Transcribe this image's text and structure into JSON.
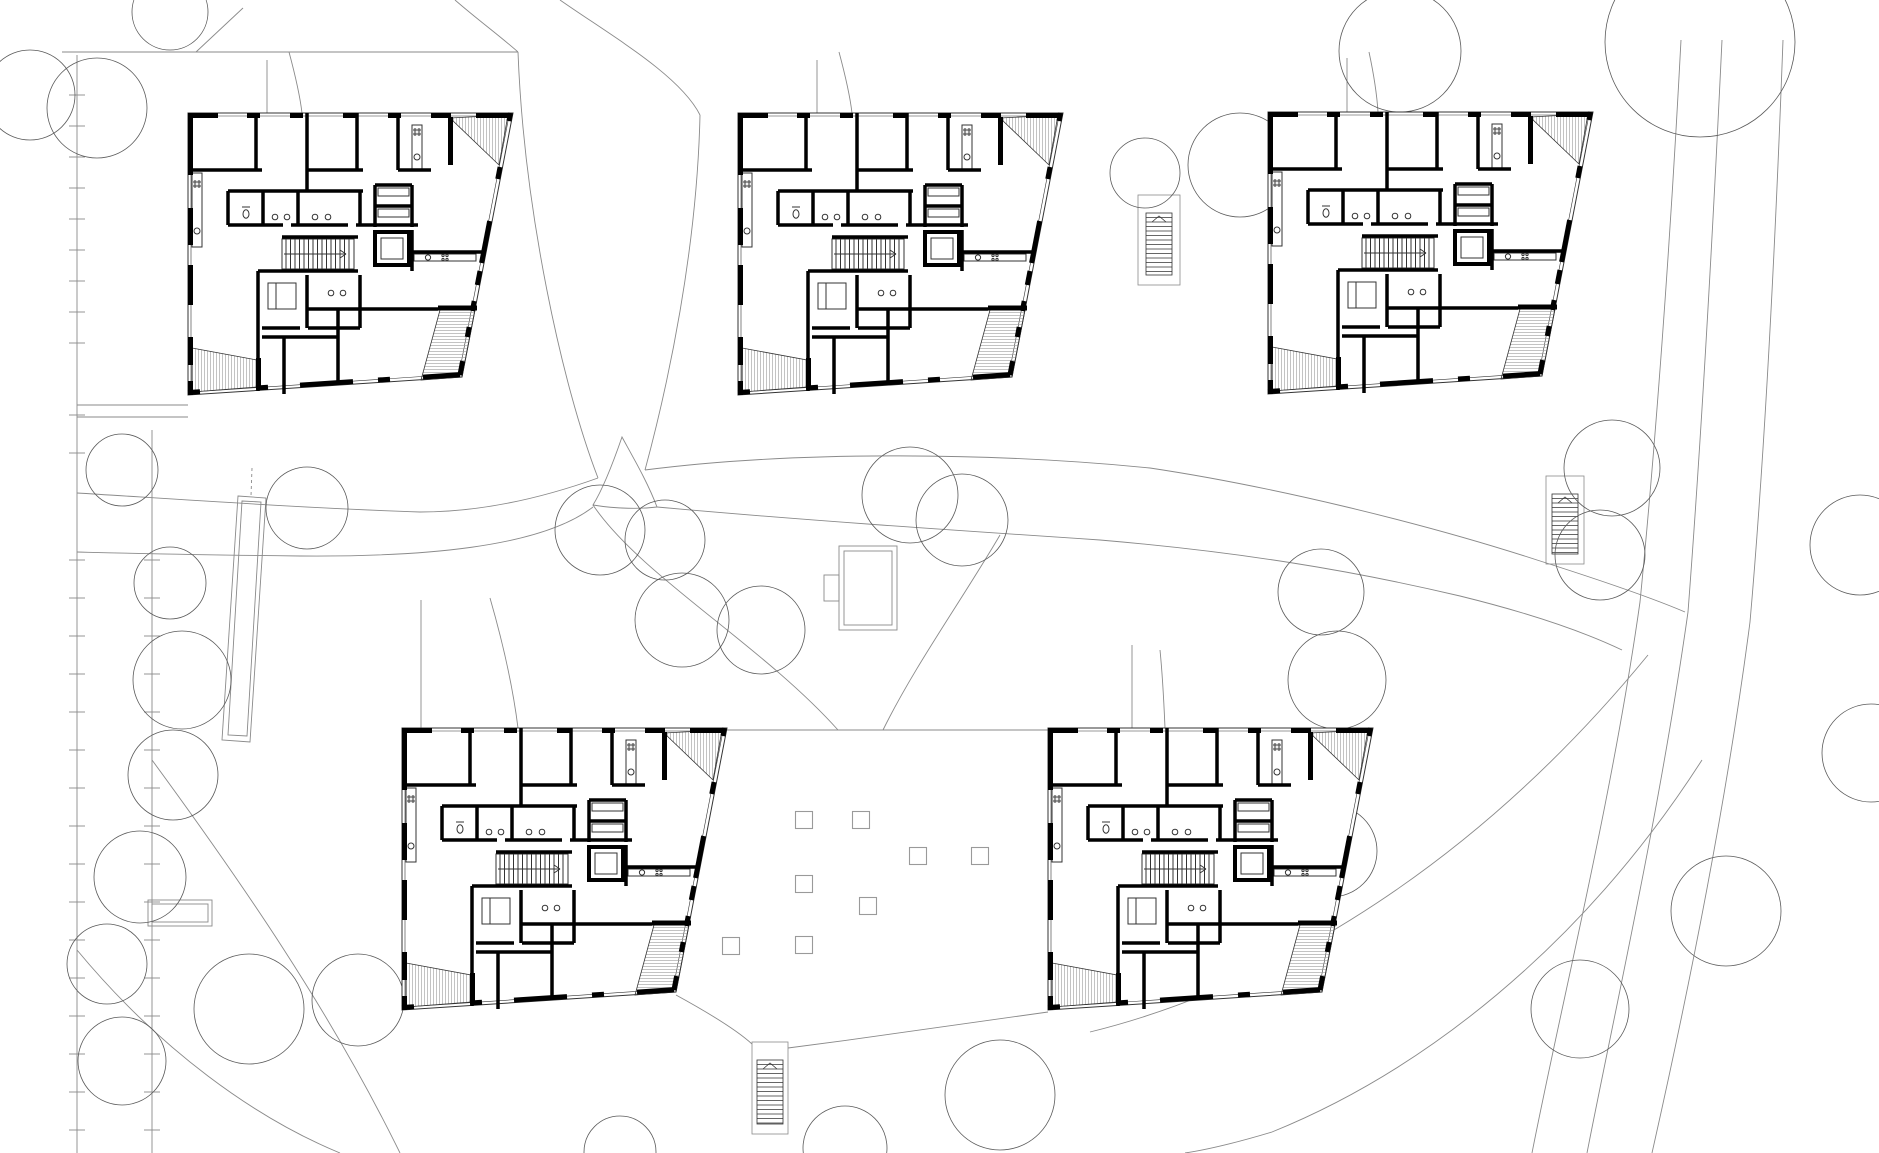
{
  "meta": {
    "drawing_type": "architectural-site-plan-ground-floor",
    "canvas_width": 1879,
    "canvas_height": 1153,
    "building_count": 5,
    "aria_label": "architectural site plan with five apartment building floor plans"
  },
  "style": {
    "background": "#ffffff",
    "wall_color": "#000000",
    "interior_line": "#333333",
    "site_line": "#8a8a8a",
    "tree_line": "#5a5a5a",
    "hatch_line": "#9a9a9a",
    "square_line": "#9a9a9a"
  },
  "buildings": [
    {
      "id": "building-1",
      "x": 188,
      "y": 113
    },
    {
      "id": "building-2",
      "x": 738,
      "y": 113
    },
    {
      "id": "building-3",
      "x": 1268,
      "y": 112
    },
    {
      "id": "building-4",
      "x": 402,
      "y": 728
    },
    {
      "id": "building-5",
      "x": 1048,
      "y": 728
    }
  ],
  "trees": [
    [
      97,
      108,
      50
    ],
    [
      30,
      95,
      45
    ],
    [
      170,
      12,
      38
    ],
    [
      122,
      470,
      36
    ],
    [
      307,
      508,
      41
    ],
    [
      170,
      583,
      36
    ],
    [
      182,
      680,
      49
    ],
    [
      173,
      775,
      45
    ],
    [
      140,
      877,
      46
    ],
    [
      107,
      964,
      40
    ],
    [
      122,
      1061,
      44
    ],
    [
      249,
      1009,
      55
    ],
    [
      358,
      1000,
      46
    ],
    [
      682,
      620,
      47
    ],
    [
      761,
      630,
      44
    ],
    [
      600,
      530,
      45
    ],
    [
      665,
      540,
      40
    ],
    [
      910,
      495,
      48
    ],
    [
      962,
      520,
      46
    ],
    [
      1145,
      173,
      35
    ],
    [
      1240,
      165,
      52
    ],
    [
      1400,
      51,
      61
    ],
    [
      1700,
      42,
      95
    ],
    [
      1612,
      468,
      48
    ],
    [
      1600,
      555,
      45
    ],
    [
      1321,
      592,
      43
    ],
    [
      1337,
      680,
      49
    ],
    [
      1318,
      772,
      40
    ],
    [
      1331,
      851,
      46
    ],
    [
      1245,
      942,
      55
    ],
    [
      1580,
      1009,
      49
    ],
    [
      1726,
      911,
      55
    ],
    [
      1860,
      545,
      50
    ],
    [
      1871,
      753,
      49
    ],
    [
      620,
      1152,
      36
    ],
    [
      845,
      1148,
      42
    ],
    [
      1000,
      1095,
      55
    ]
  ],
  "plaza": {
    "square_size": 17,
    "squares": [
      [
        804,
        820
      ],
      [
        861,
        820
      ],
      [
        918,
        856
      ],
      [
        980,
        856
      ],
      [
        804,
        884
      ],
      [
        868,
        906
      ],
      [
        731,
        946
      ],
      [
        804,
        945
      ]
    ],
    "edges": [
      "M727,730 H1048",
      "M676,995 C718,1018 740,1033 752,1044",
      "M788,1048 C880,1036 980,1022 1048,1012"
    ]
  },
  "outdoor_stairs": [
    {
      "x": 1138,
      "y": 195,
      "w": 42,
      "h": 90
    },
    {
      "x": 1546,
      "y": 476,
      "w": 38,
      "h": 88
    },
    {
      "x": 752,
      "y": 1042,
      "w": 36,
      "h": 92
    }
  ],
  "pool": {
    "points": "238,496 266,498 250,742 222,740",
    "inner_points": "242,501 261,502 247,736 228,735",
    "dash": "M252,468 L251,496"
  },
  "shelter": {
    "x": 148,
    "y": 900,
    "w": 64,
    "h": 26
  },
  "pavilion": {
    "x": 839,
    "y": 546,
    "w": 58,
    "h": 84,
    "tab_x": 824,
    "tab_y": 575,
    "tab_w": 15,
    "tab_h": 26
  },
  "parking": {
    "road_lines": [
      {
        "x": 77,
        "y1": 55,
        "y2": 1153
      },
      {
        "x": 152,
        "y1": 430,
        "y2": 1153
      }
    ],
    "tick_half": 8,
    "ticks_upper_x": 77,
    "ticks_upper_y": [
      95,
      126,
      157,
      188,
      219,
      250,
      281,
      312,
      343
    ],
    "ticks_main_y": [
      415,
      453,
      560,
      598,
      636,
      674,
      712,
      750,
      788,
      826,
      864,
      902,
      940,
      978,
      1016,
      1054,
      1092,
      1130
    ],
    "ticks_main_x77_all": true,
    "ticks_x152_from": 560
  },
  "site_paths": [
    "M62,52 H518",
    "M196,52 L243,8",
    "M455,0 C478,20 500,36 518,52",
    "M560,0 C610,35 680,75 700,115",
    "M518,52 C524,210 562,385 598,478",
    "M700,115 C697,250 668,385 645,470",
    "M267,60 V113",
    "M289,52 C296,78 300,96 302,113",
    "M817,60 V113",
    "M839,52 C846,78 850,96 852,113",
    "M1347,58 V112",
    "M1369,52 C1375,80 1377,96 1378,112",
    "M622,437 C612,466 601,492 593,505 C617,509 641,509 657,507 C648,483 634,459 622,437 Z",
    "M598,478 C520,506 460,512 420,512 C300,508 160,498 77,493",
    "M593,507 C540,548 420,557 300,556 C200,555 120,553 77,552",
    "M645,470 C800,450 1000,453 1150,468 C1270,486 1420,522 1537,560 C1600,580 1650,597 1685,612",
    "M657,507 C800,520 950,530 1100,540 C1240,552 1350,570 1460,596 C1525,612 1580,630 1622,650",
    "M593,505 C640,575 762,645 838,730",
    "M1000,535 C962,600 915,665 883,730",
    "M77,405 H188",
    "M77,417 H188",
    "M152,760 C240,880 330,1010 400,1153",
    "M77,950 C160,1050 255,1118 340,1153",
    "M1681,40 C1670,250 1655,450 1640,602 C1612,800 1562,1000 1532,1153",
    "M1722,40 C1712,250 1700,455 1688,612 C1660,810 1617,1000 1587,1153",
    "M1783,40 C1775,255 1764,462 1750,622 C1724,822 1682,1020 1652,1153",
    "M1648,655 C1480,860 1280,985 1090,1032",
    "M1702,760 C1580,950 1420,1072 1272,1132 C1232,1144 1205,1150 1185,1153",
    "M421,600 V728",
    "M490,598 C505,650 514,696 518,728",
    "M1132,645 V728",
    "M1160,650 C1163,680 1164,705 1165,728"
  ]
}
